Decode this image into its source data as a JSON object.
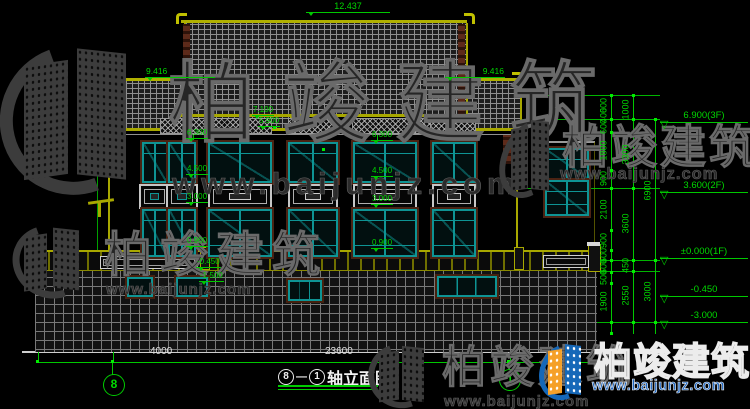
{
  "watermark": {
    "brand": "柏竣建筑",
    "url": "www.baijunjz.com"
  },
  "drawing_title": {
    "axis_from": "8",
    "separator": "—",
    "axis_to": "1",
    "text": "轴立面图"
  },
  "axis_bubbles": {
    "left": "8",
    "right": "1"
  },
  "roof_markers": {
    "ridge": "12.437",
    "left_eave": "9.416",
    "right_eave": "9.416"
  },
  "facade_markers": {
    "top1": "7.100",
    "top2": "5.900",
    "left": [
      "6.300",
      "4.500",
      "3.000",
      "0.900"
    ],
    "right": [
      "6.300",
      "4.500",
      "3.000",
      "0.900"
    ],
    "base": [
      "-0.450",
      "-1.500"
    ]
  },
  "level_markers": [
    "6.900(3F)",
    "3.600(2F)",
    "±0.000(1F)",
    "-0.450",
    "-3.000"
  ],
  "dim_chains": {
    "inner": [
      "600",
      "400",
      "600",
      "1800",
      "900",
      "2100",
      "900",
      "600",
      "600",
      "500",
      "1900"
    ],
    "middle": [
      "1000",
      "3300",
      "3600",
      "450",
      "2550"
    ],
    "outer": [
      "6900",
      "3000"
    ]
  },
  "bottom_dims": {
    "left_bay": "4000",
    "overall": "23600"
  },
  "colors": {
    "line_green": "#00c800",
    "dim_white": "#e0e0e0",
    "frame_teal": "#0e9494",
    "trim_yellow": "#a8a800",
    "brick_mortar": "#787878",
    "watermark_gray": "#3c3c3c",
    "logo_blue": "#1668b8",
    "logo_orange": "#f5a028",
    "url_blue": "#1e66c0"
  }
}
